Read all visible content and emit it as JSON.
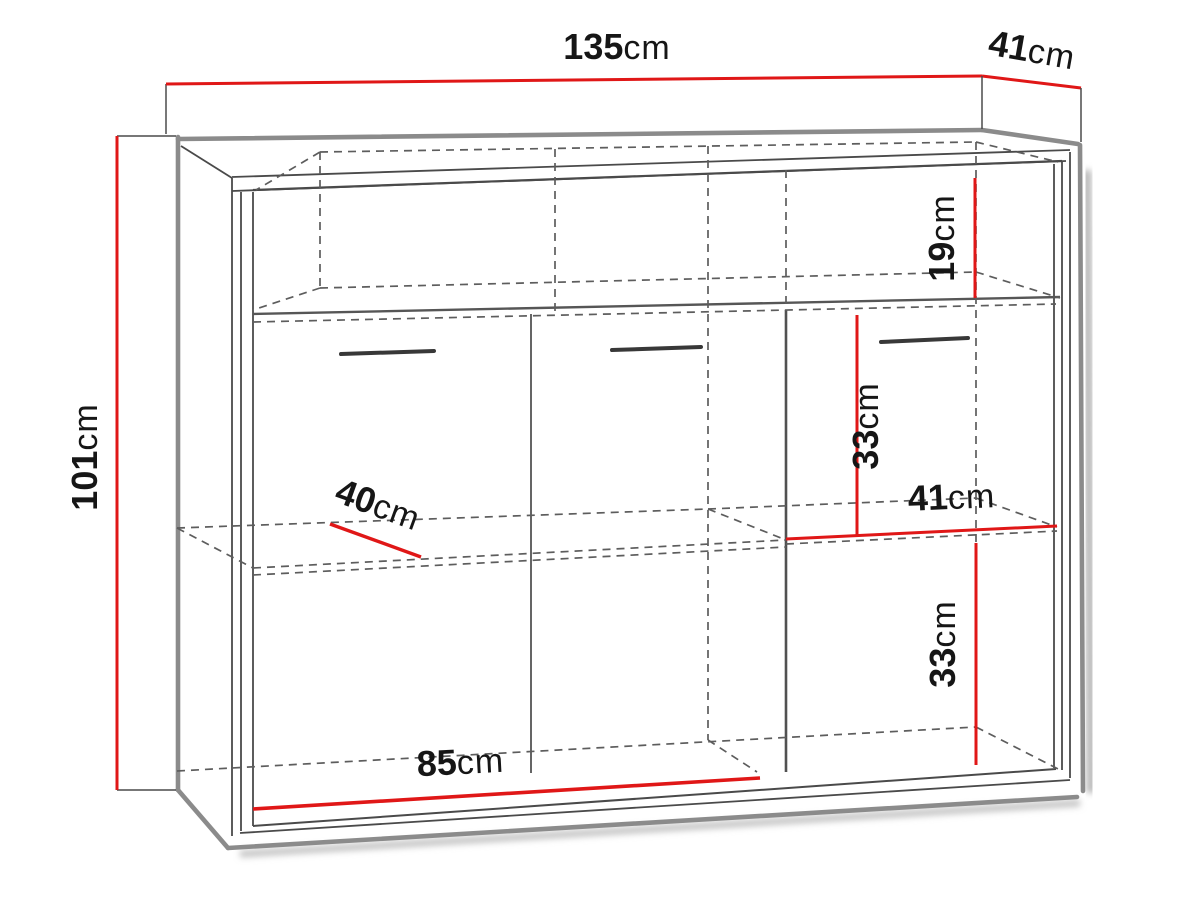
{
  "diagram": {
    "kind": "sideboard-cabinet-dimension-drawing",
    "unit": "cm",
    "colors": {
      "dimension_line": "#e01717",
      "heavy_edge": "#8b8b8b",
      "edge": "#4a4a4a",
      "hidden_edge": "#5d5d5d",
      "label_text": "#161616",
      "background": "#ffffff"
    },
    "dimensions": {
      "total_width": {
        "value": "135",
        "unit": "cm"
      },
      "total_depth": {
        "value": "41",
        "unit": "cm"
      },
      "total_height": {
        "value": "101",
        "unit": "cm"
      },
      "top_compartment_height": {
        "value": "19",
        "unit": "cm"
      },
      "right_upper_section_height": {
        "value": "33",
        "unit": "cm"
      },
      "right_section_width": {
        "value": "41",
        "unit": "cm"
      },
      "right_lower_section_height": {
        "value": "33",
        "unit": "cm"
      },
      "shelf_depth": {
        "value": "40",
        "unit": "cm"
      },
      "door_section_width": {
        "value": "85",
        "unit": "cm"
      }
    }
  }
}
